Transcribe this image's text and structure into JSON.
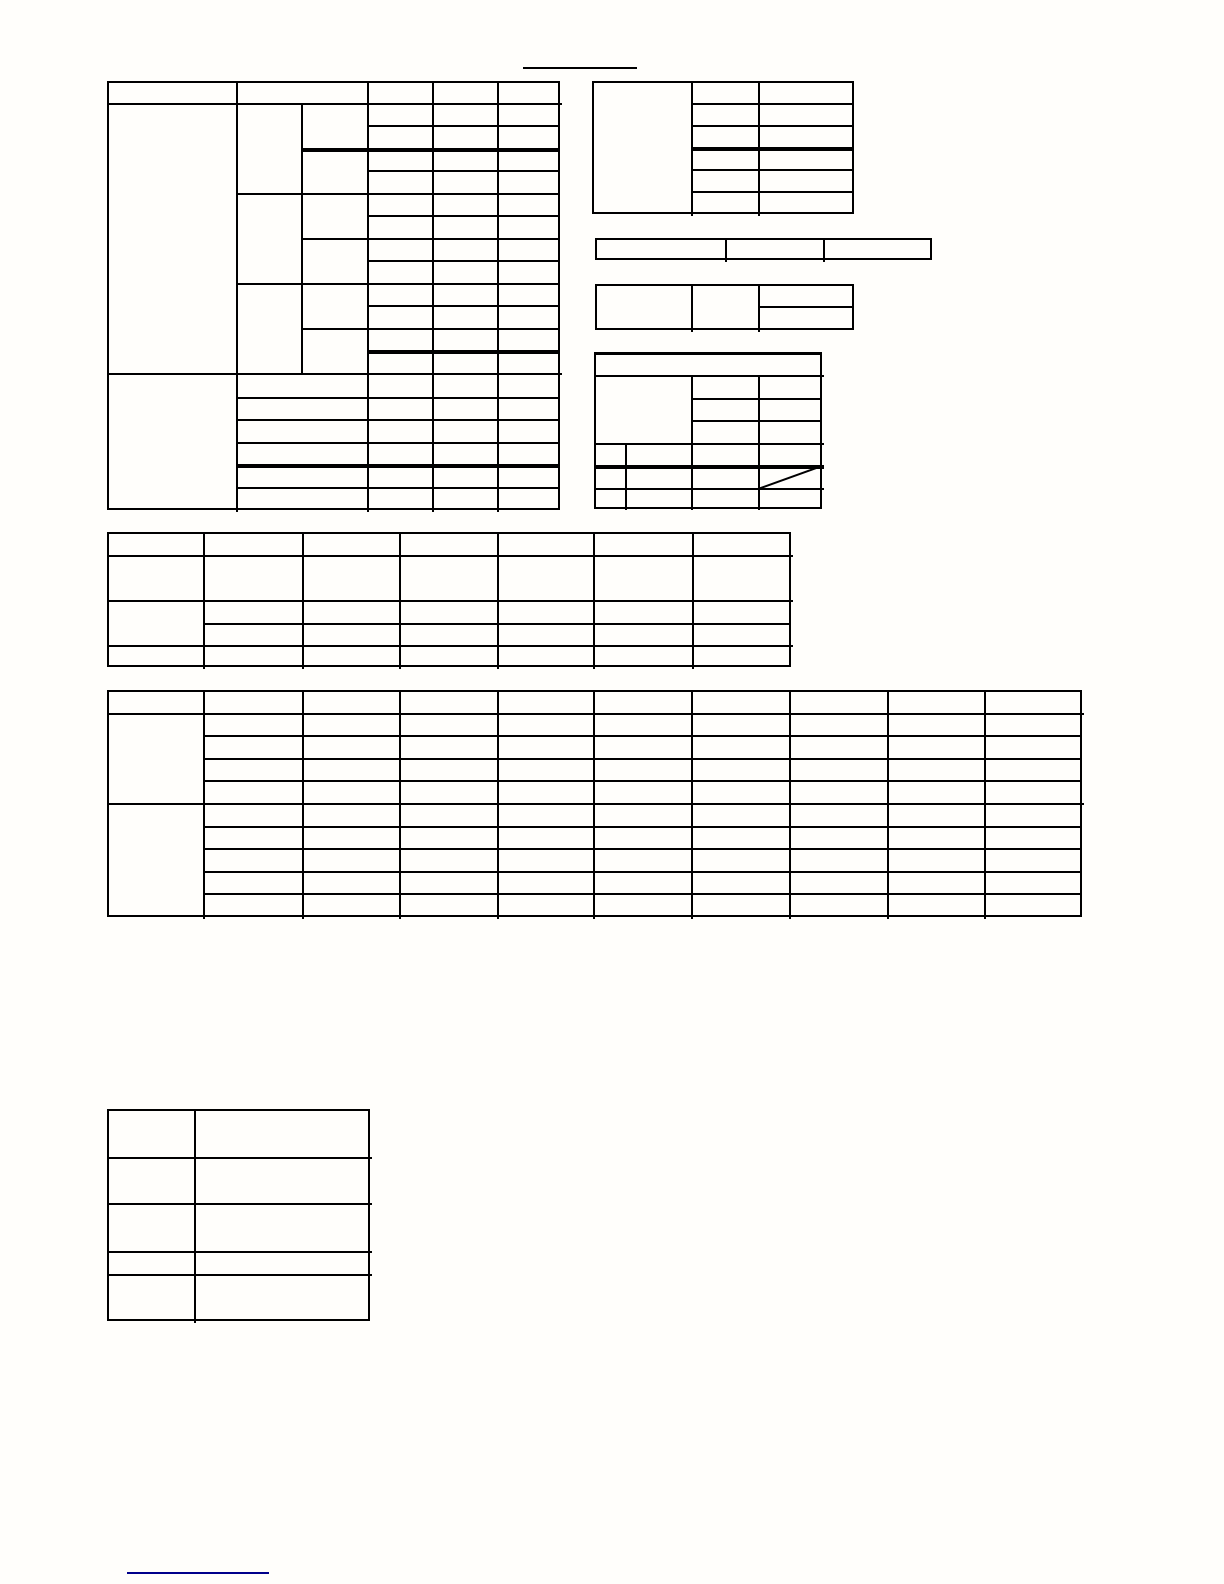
{
  "page": {
    "kind": "scanned blank tabular form page - all table cells are empty, no visible text",
    "background_color": "#fffefb",
    "grid_line_color": "#000000",
    "title_rule_color": "#000000",
    "footer_link_rule_color": "#00008b"
  },
  "tables": {
    "a": {
      "caption": "",
      "note": "left large table: 5 header cells, merged stub column, 12 upper rows, 6 lower rows"
    },
    "b": {
      "caption": "",
      "note": "top right table: merged left cell, 2 columns x 6 rows"
    },
    "c": {
      "caption": "",
      "note": "single row strip with 3 cells"
    },
    "d": {
      "caption": "",
      "note": "small table: two merged cells and a split right column"
    },
    "e": {
      "caption": "",
      "note": "right table with merged header band and diagonal slash cell"
    },
    "f": {
      "caption": "",
      "note": "wide table: 7 columns x 5 rows, merged stub cell"
    },
    "g": {
      "caption": "",
      "note": "large wide table: 10 columns x 10 rows, two merged stub sections"
    },
    "h": {
      "caption": "",
      "note": "bottom left table: 2 columns x 5 rows"
    }
  },
  "decorations": {
    "title_underline_text": "",
    "footer_link_text": ""
  }
}
